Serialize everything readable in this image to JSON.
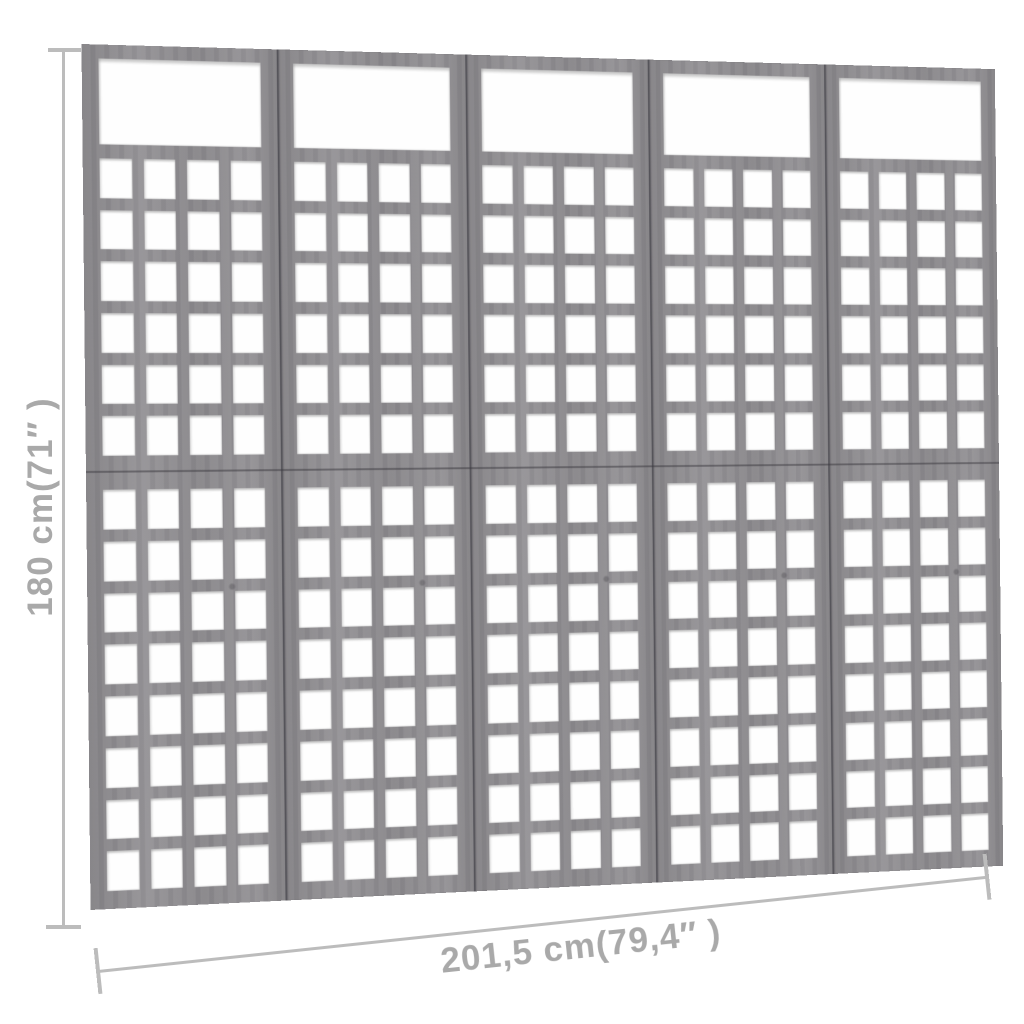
{
  "product": {
    "name": "5-panel wooden trellis room divider",
    "finish": "gray"
  },
  "structure": {
    "panel_count": 5,
    "grid_cols": 4,
    "upper_grid_rows": 6,
    "lower_grid_rows": 8,
    "has_top_opening": true
  },
  "dimensions": {
    "height_label": "180 cm(71″ )",
    "width_label": "201,5 cm(79,4″ )"
  },
  "colors": {
    "wood_base": "#8f8d91",
    "panel_seam": "#55535a",
    "opening_white": "#fefefe",
    "dimension_line": "#bcbcbc",
    "dimension_text": "#a9a9a9",
    "background": "#ffffff"
  }
}
